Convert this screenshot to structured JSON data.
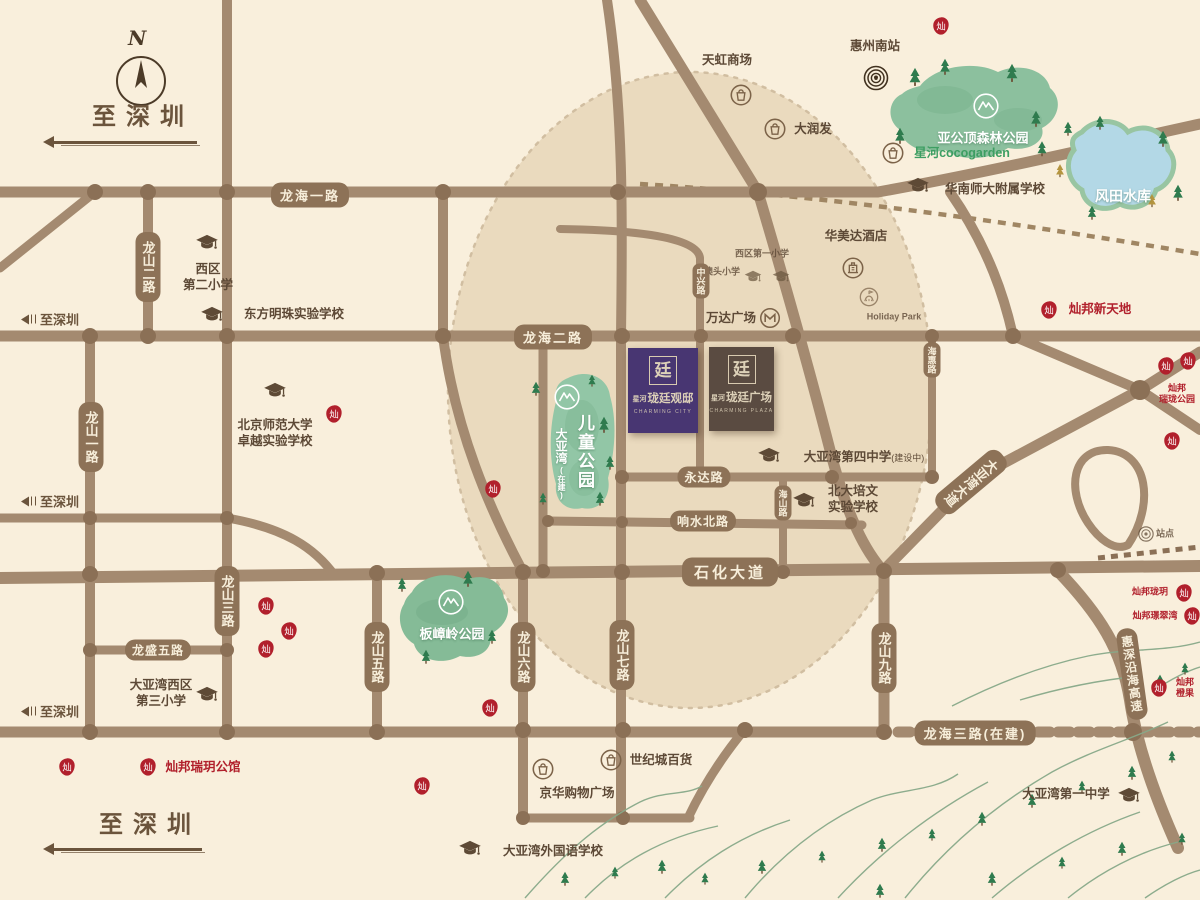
{
  "compass": {
    "north": "N"
  },
  "colors": {
    "background": "#f9efdc",
    "road": "#a48a70",
    "road_node": "#8b7056",
    "pill": "#8d7257",
    "radius_fill": "#dcc6a2",
    "park_green": "#8fc2a0",
    "lake_blue": "#b3d8e6",
    "accent_red": "#b1202c",
    "text_brown": "#5d4936",
    "purple_box": "#483672",
    "brown_box": "#5a4b41"
  },
  "directions": [
    {
      "id": "to-shenzhen-top",
      "text": "至深圳",
      "style": "large",
      "x": 143,
      "y": 114,
      "arrow": [
        47,
        197,
        141
      ]
    },
    {
      "id": "to-shenzhen-mid-1",
      "text": "至深圳",
      "style": "small",
      "x": 16,
      "y": 319
    },
    {
      "id": "to-shenzhen-mid-2",
      "text": "至深圳",
      "style": "small",
      "x": 16,
      "y": 501
    },
    {
      "id": "to-shenzhen-mid-3",
      "text": "至深圳",
      "style": "small",
      "x": 16,
      "y": 711
    },
    {
      "id": "to-shenzhen-bottom",
      "text": "至深圳",
      "style": "large",
      "x": 150,
      "y": 822,
      "arrow": [
        47,
        202,
        848
      ]
    }
  ],
  "roads": [
    {
      "id": "longhai-1st-rd",
      "label": "龙海一路",
      "x": 310,
      "y": 195
    },
    {
      "id": "longhai-2nd-rd",
      "label": "龙海二路",
      "x": 553,
      "y": 337
    },
    {
      "id": "shihua-ave",
      "label": "石化大道",
      "x": 730,
      "y": 572,
      "size": "lg"
    },
    {
      "id": "longhai-3rd-rd",
      "label": "龙海三路(在建)",
      "x": 975,
      "y": 733
    },
    {
      "id": "yongda-rd",
      "label": "永达路",
      "x": 704,
      "y": 477,
      "size": "sm"
    },
    {
      "id": "xiangshui-north-rd",
      "label": "响水北路",
      "x": 703,
      "y": 521,
      "size": "sm"
    },
    {
      "id": "longsheng-5th-rd",
      "label": "龙盛五路",
      "x": 158,
      "y": 650,
      "size": "sm"
    },
    {
      "id": "longshan-1st-rd",
      "label": "龙山一路",
      "x": 91,
      "y": 437,
      "v": true
    },
    {
      "id": "longshan-2nd-rd",
      "label": "龙山二路",
      "x": 148,
      "y": 267,
      "v": true
    },
    {
      "id": "longshan-3rd-rd",
      "label": "龙山三路",
      "x": 227,
      "y": 601,
      "v": true
    },
    {
      "id": "longshan-5th-rd",
      "label": "龙山五路",
      "x": 377,
      "y": 657,
      "v": true
    },
    {
      "id": "longshan-6th-rd",
      "label": "龙山六路",
      "x": 523,
      "y": 657,
      "v": true
    },
    {
      "id": "longshan-7th-rd",
      "label": "龙山七路",
      "x": 622,
      "y": 655,
      "v": true
    },
    {
      "id": "longshan-9th-rd",
      "label": "龙山九路",
      "x": 884,
      "y": 658,
      "v": true
    },
    {
      "id": "zhongxing-rd",
      "label": "中兴路",
      "x": 701,
      "y": 281,
      "v": true,
      "size": "xs"
    },
    {
      "id": "haishan-rd",
      "label": "海山路",
      "x": 783,
      "y": 503,
      "v": true,
      "size": "xs"
    },
    {
      "id": "haihui-rd",
      "label": "海惠路",
      "x": 932,
      "y": 360,
      "v": true,
      "size": "xs"
    },
    {
      "id": "dayawan-ave",
      "label": "大亚湾大道",
      "x": 971,
      "y": 482,
      "v": true,
      "rot": 50
    },
    {
      "id": "huishen-coastal-expwy",
      "label": "惠深沿海高速",
      "x": 1132,
      "y": 674,
      "v": true,
      "rot": -8,
      "size": "sm"
    }
  ],
  "projects": [
    {
      "id": "longting-guandi",
      "logo": "廷",
      "prefix": "星河",
      "name": "珑廷观邸",
      "en": "CHARMING CITY",
      "bg": "#483672",
      "x": 628,
      "y": 348,
      "w": 70,
      "h": 85
    },
    {
      "id": "longting-plaza",
      "logo": "廷",
      "prefix": "星河",
      "name": "珑廷广场",
      "en": "CHARMING PLAZA",
      "bg": "#5a4b41",
      "x": 709,
      "y": 347,
      "w": 65,
      "h": 84
    }
  ],
  "parks": [
    {
      "id": "yagongding-forest-park",
      "label": "亚公顶森林公园",
      "label_pos": [
        983,
        137
      ],
      "icon": [
        986,
        106
      ]
    },
    {
      "id": "banzhangling-park",
      "label": "板嶂岭公园",
      "label_pos": [
        452,
        633
      ],
      "icon": [
        451,
        602
      ]
    },
    {
      "id": "dayawan-children-park",
      "label": "儿童公园",
      "label2": "大亚湾",
      "label3": "(在建)",
      "label_pos": [
        575,
        457
      ],
      "icon": [
        567,
        397
      ],
      "vertical": true
    }
  ],
  "lake": {
    "id": "fengtian-reservoir",
    "label": "风田水库",
    "label_pos": [
      1123,
      196
    ]
  },
  "pois": [
    {
      "id": "huizhou-south-station",
      "type": "station",
      "icon": [
        876,
        78
      ],
      "label": "惠州南站",
      "label_pos": [
        875,
        46
      ]
    },
    {
      "id": "tianhong-mall",
      "type": "mall",
      "icon": [
        741,
        95
      ],
      "label": "天虹商场",
      "label_pos": [
        727,
        60
      ]
    },
    {
      "id": "rt-mart",
      "type": "mall",
      "icon": [
        775,
        129
      ],
      "label": "大润发",
      "label_pos": [
        813,
        129
      ]
    },
    {
      "id": "cocogarden",
      "type": "mall",
      "icon": [
        893,
        153
      ],
      "label": "星河cocogarden",
      "label_pos": [
        962,
        153
      ],
      "cls": "green"
    },
    {
      "id": "scnu-affiliated-school",
      "type": "school",
      "icon": [
        918,
        186
      ],
      "label": "华南师大附属学校",
      "label_pos": [
        995,
        189
      ]
    },
    {
      "id": "ramada-hotel",
      "type": "hotel",
      "icon": [
        853,
        268
      ],
      "label": "华美达酒店",
      "label_pos": [
        856,
        236
      ]
    },
    {
      "id": "holiday-park",
      "type": "misc",
      "icon": [
        869,
        297
      ],
      "label": "Holiday Park",
      "label_pos": [
        894,
        317
      ],
      "cls": "tiny faint"
    },
    {
      "id": "wanda-plaza",
      "type": "metro",
      "icon": [
        770,
        318
      ],
      "label": "万达广场",
      "label_pos": [
        731,
        318
      ]
    },
    {
      "id": "xiqu-1st-primary",
      "type": "school2",
      "icon": [
        753,
        277
      ],
      "label": "西区第一小学",
      "label_pos": [
        762,
        254
      ],
      "cls": "tiny faint"
    },
    {
      "id": "aotou-primary",
      "type": "school2",
      "icon": [
        781,
        277
      ],
      "label": "澳头小学",
      "label_pos": [
        722,
        272
      ],
      "cls": "tiny faint"
    },
    {
      "id": "xiqu-2nd-primary",
      "type": "school",
      "icon": [
        207,
        243
      ],
      "label": "西区",
      "label2": "第二小学",
      "label_pos": [
        208,
        277
      ]
    },
    {
      "id": "dongfang-mingzhu-school",
      "type": "school",
      "icon": [
        212,
        315
      ],
      "label": "东方明珠实验学校",
      "label_pos": [
        294,
        314
      ]
    },
    {
      "id": "bnu-zhuoyue-school",
      "type": "school",
      "icon": [
        275,
        391
      ],
      "label": "北京师范大学",
      "label2": "卓越实验学校",
      "label_pos": [
        275,
        433
      ]
    },
    {
      "id": "dayawan-4th-middle",
      "type": "school",
      "icon": [
        769,
        456
      ],
      "label": "大亚湾第四中学",
      "suffix": "(建设中)",
      "label_pos": [
        864,
        457
      ]
    },
    {
      "id": "beida-peiwen-school",
      "type": "school",
      "icon": [
        804,
        501
      ],
      "label": "北大培文",
      "label2": "实验学校",
      "label_pos": [
        853,
        499
      ]
    },
    {
      "id": "xiqu-3rd-primary",
      "type": "school",
      "icon": [
        207,
        695
      ],
      "label": "大亚湾西区",
      "label2": "第三小学",
      "label_pos": [
        161,
        693
      ]
    },
    {
      "id": "dayawan-foreign-lang-school",
      "type": "school",
      "icon": [
        470,
        849
      ],
      "label": "大亚湾外国语学校",
      "label_pos": [
        553,
        851
      ]
    },
    {
      "id": "dayawan-1st-middle",
      "type": "school",
      "icon": [
        1129,
        796
      ],
      "label": "大亚湾第一中学",
      "label_pos": [
        1066,
        794
      ]
    },
    {
      "id": "century-mall",
      "type": "mall",
      "icon": [
        611,
        760
      ],
      "label": "世纪城百货",
      "label_pos": [
        661,
        760
      ]
    },
    {
      "id": "jinghua-shopping-plaza",
      "type": "mall",
      "icon": [
        543,
        769
      ],
      "label": "京华购物广场",
      "label_pos": [
        577,
        793
      ]
    },
    {
      "id": "station-east",
      "type": "stationsm",
      "icon": [
        1146,
        534
      ],
      "label": "站点",
      "label_pos": [
        1165,
        534
      ],
      "cls": "tiny faint"
    },
    {
      "id": "canbang-xintiandi",
      "type": "seal",
      "icon": [
        1049,
        310
      ],
      "label": "灿邦新天地",
      "label_pos": [
        1100,
        309
      ],
      "cls": "red"
    },
    {
      "id": "canbang-ruiyue-mansion",
      "type": "seal",
      "icon": [
        148,
        767
      ],
      "label": "灿邦瑞玥公馆",
      "label_pos": [
        203,
        767
      ],
      "cls": "red"
    },
    {
      "id": "canbang-longyue",
      "type": "seal",
      "icon": [
        1184,
        593
      ],
      "label": "灿邦珑玥",
      "label_pos": [
        1150,
        592
      ],
      "cls": "red tiny"
    },
    {
      "id": "canbang-jingcuiwan",
      "type": "seal",
      "icon": [
        1192,
        616
      ],
      "label": "灿邦璟翠湾",
      "label_pos": [
        1155,
        616
      ],
      "cls": "red tiny"
    },
    {
      "id": "canbang-chengguo",
      "type": "seal",
      "icon": [
        1159,
        688
      ],
      "label": "灿邦",
      "label2": "橙果",
      "label_pos": [
        1185,
        688
      ],
      "cls": "red tiny"
    },
    {
      "id": "canbang-ruilong-park",
      "type": "seal",
      "icon": [
        1166,
        366
      ],
      "icon2": [
        1188,
        361
      ],
      "label": "灿邦",
      "label2": "瑞珑公园",
      "label_pos": [
        1177,
        394
      ],
      "cls": "red tiny"
    },
    {
      "id": "seal-a",
      "type": "seal",
      "icon": [
        941,
        26
      ]
    },
    {
      "id": "seal-b",
      "type": "seal",
      "icon": [
        334,
        414
      ]
    },
    {
      "id": "seal-c",
      "type": "seal",
      "icon": [
        493,
        489
      ]
    },
    {
      "id": "seal-d",
      "type": "seal",
      "icon": [
        266,
        606
      ]
    },
    {
      "id": "seal-e",
      "type": "seal",
      "icon": [
        289,
        631
      ]
    },
    {
      "id": "seal-f",
      "type": "seal",
      "icon": [
        266,
        649
      ]
    },
    {
      "id": "seal-g",
      "type": "seal",
      "icon": [
        67,
        767
      ]
    },
    {
      "id": "seal-h",
      "type": "seal",
      "icon": [
        490,
        708
      ]
    },
    {
      "id": "seal-i",
      "type": "seal",
      "icon": [
        422,
        786
      ]
    },
    {
      "id": "seal-j",
      "type": "seal",
      "icon": [
        1172,
        441
      ]
    }
  ]
}
